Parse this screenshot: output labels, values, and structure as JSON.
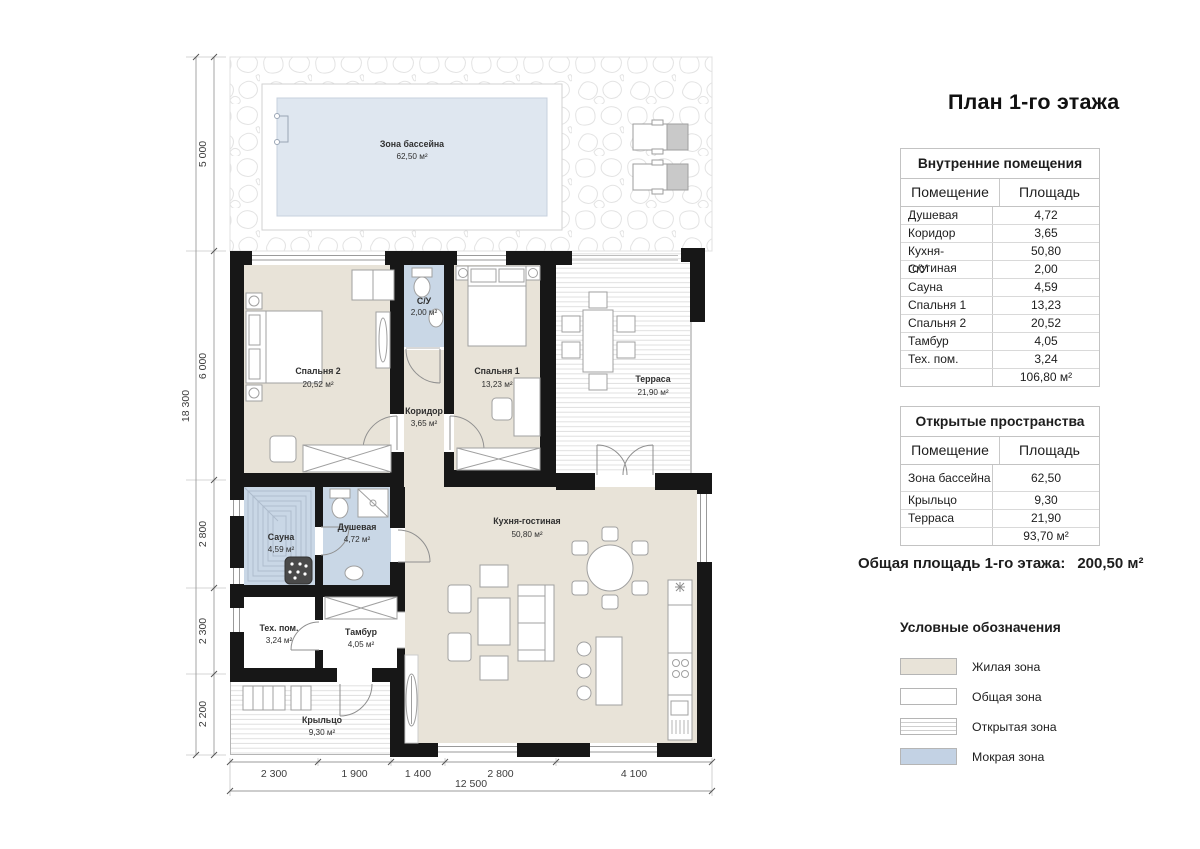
{
  "page_title": "План 1-го этажа",
  "plan": {
    "rooms": {
      "pool": {
        "name": "Зона бассейна",
        "area": "62,50 м²"
      },
      "bedroom2": {
        "name": "Спальня 2",
        "area": "20,52 м²"
      },
      "bathroom": {
        "name": "С/У",
        "area": "2,00 м²"
      },
      "corridor": {
        "name": "Коридор",
        "area": "3,65 м²"
      },
      "bedroom1": {
        "name": "Спальня 1",
        "area": "13,23 м²"
      },
      "terrace": {
        "name": "Терраса",
        "area": "21,90 м²"
      },
      "sauna": {
        "name": "Сауна",
        "area": "4,59 м²"
      },
      "shower": {
        "name": "Душевая",
        "area": "4,72 м²"
      },
      "tech": {
        "name": "Тех. пом.",
        "area": "3,24 м²"
      },
      "tambour": {
        "name": "Тамбур",
        "area": "4,05 м²"
      },
      "kitchen": {
        "name": "Кухня-гостиная",
        "area": "50,80 м²"
      },
      "porch": {
        "name": "Крыльцо",
        "area": "9,30 м²"
      }
    },
    "dim_left": [
      "5 000",
      "6 000",
      "2 800",
      "2 300",
      "2 200"
    ],
    "dim_left_total": "18 300",
    "dim_bottom": [
      "2 300",
      "1 900",
      "1 400",
      "2 800",
      "4 100"
    ],
    "dim_bottom_total": "12 500"
  },
  "tables": {
    "interior": {
      "title": "Внутренние помещения",
      "col_room": "Помещение",
      "col_area": "Площадь",
      "rows": [
        [
          "Душевая",
          "4,72"
        ],
        [
          "Коридор",
          "3,65"
        ],
        [
          "Кухня-гостиная",
          "50,80"
        ],
        [
          "С/У",
          "2,00"
        ],
        [
          "Сауна",
          "4,59"
        ],
        [
          "Спальня 1",
          "13,23"
        ],
        [
          "Спальня 2",
          "20,52"
        ],
        [
          "Тамбур",
          "4,05"
        ],
        [
          "Тех. пом.",
          "3,24"
        ]
      ],
      "total": "106,80 м²"
    },
    "open": {
      "title": "Открытые пространства",
      "col_room": "Помещение",
      "col_area": "Площадь",
      "rows": [
        [
          "Зона бассейна",
          "62,50"
        ],
        [
          "Крыльцо",
          "9,30"
        ],
        [
          "Терраса",
          "21,90"
        ]
      ],
      "total": "93,70 м²"
    }
  },
  "summary": {
    "label": "Общая площадь 1-го этажа:",
    "value": "200,50 м²"
  },
  "legend": {
    "title": "Условные обозначения",
    "items": [
      {
        "label": "Жилая зона",
        "color": "#e8e3d8",
        "pattern": "solid"
      },
      {
        "label": "Общая зона",
        "color": "#ffffff",
        "pattern": "solid"
      },
      {
        "label": "Открытая зона",
        "color": "#ffffff",
        "pattern": "lines"
      },
      {
        "label": "Мокрая зона",
        "color": "#c3d2e4",
        "pattern": "solid"
      }
    ]
  },
  "colors": {
    "living": "#e8e3d8",
    "wet": "#c9d7e6",
    "pool": "#dfe7f0",
    "wall": "#171717"
  }
}
